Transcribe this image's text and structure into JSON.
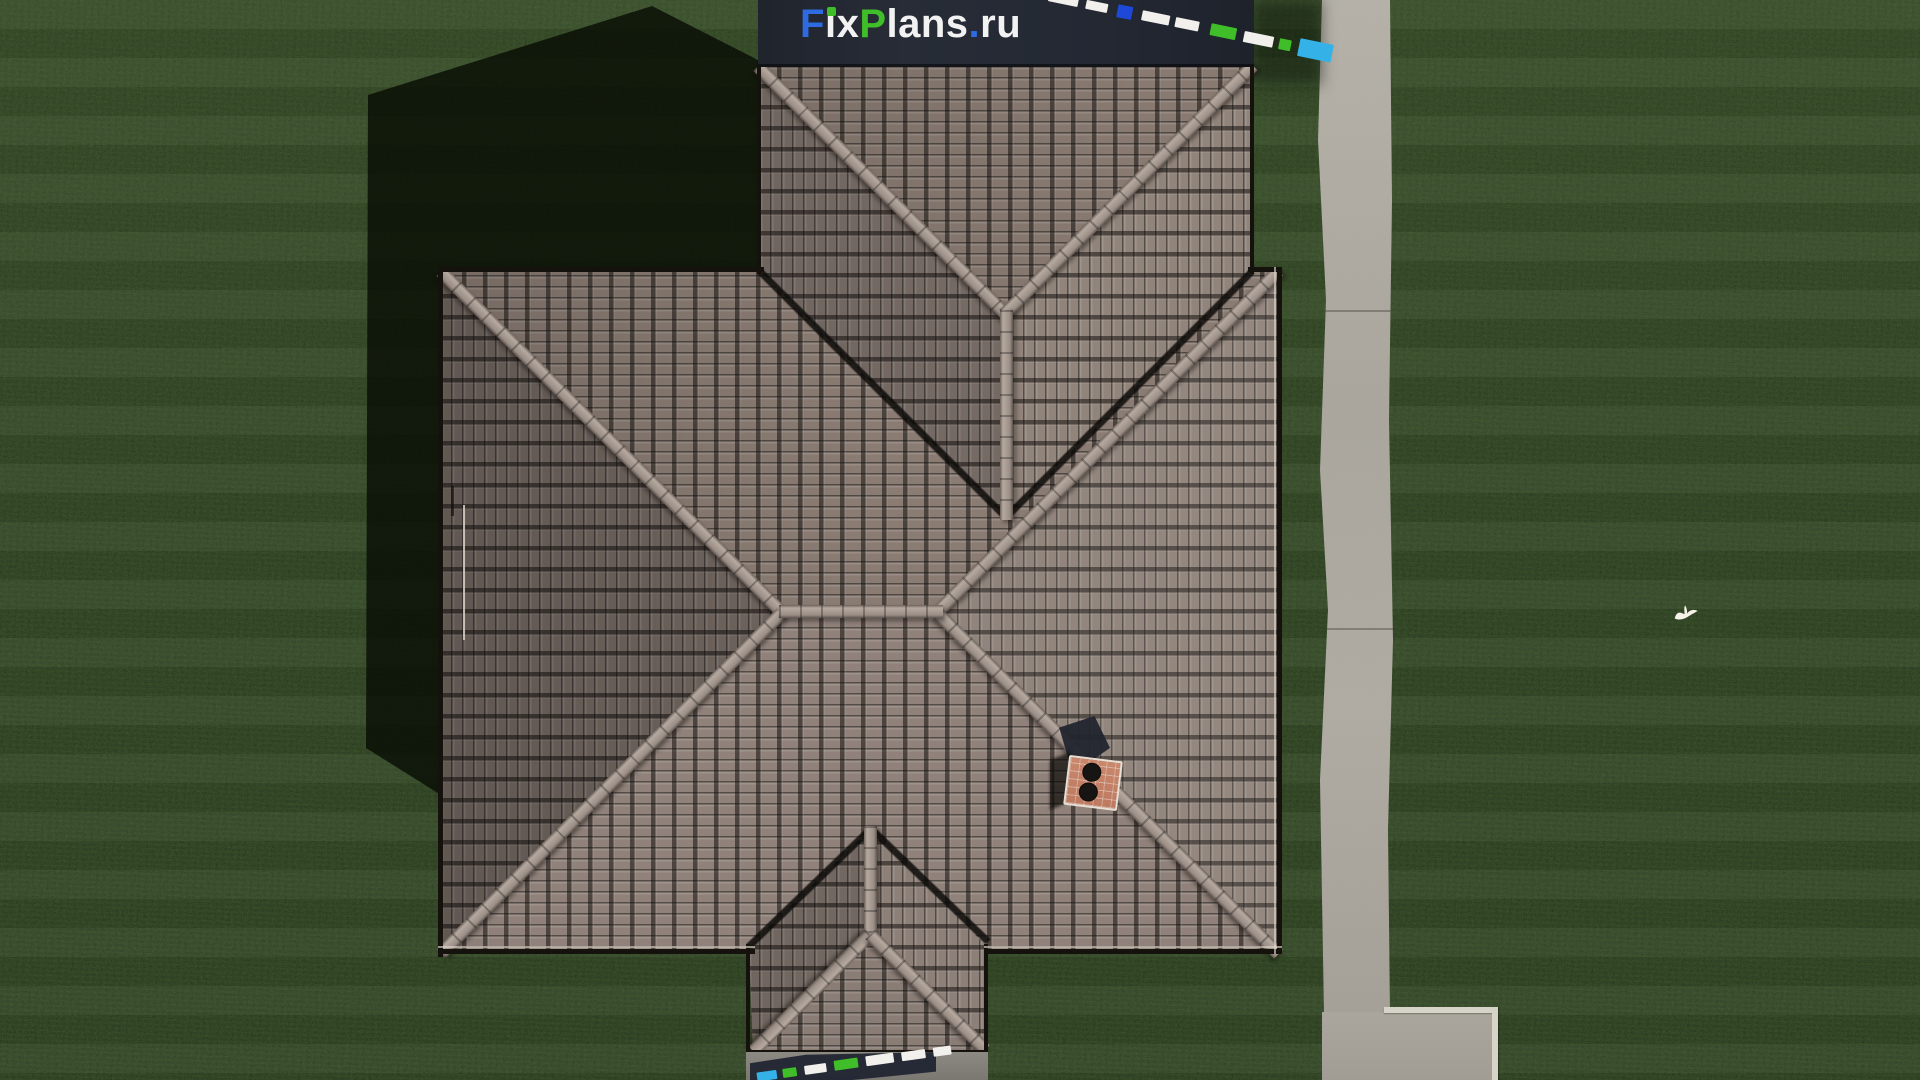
{
  "site_watermark": {
    "text": "FixPlans.ru",
    "parts": [
      {
        "text": "F",
        "color": "#2e6be0"
      },
      {
        "text": "i",
        "color": "#f2f2f2"
      },
      {
        "text": "x",
        "color": "#f2f2f2"
      },
      {
        "text": "P",
        "color": "#3fbe2a"
      },
      {
        "text": "lans",
        "color": "#f2f2f2"
      },
      {
        "text": ".",
        "color": "#2e6be0"
      },
      {
        "text": "ru",
        "color": "#f2f2f2"
      }
    ],
    "i_dot_color": "#3fbe2a"
  },
  "mini_watermarks": {
    "top_right": [
      {
        "c": "#f2f0ec",
        "w": 30,
        "h": 10,
        "g": 8
      },
      {
        "c": "#f2f0ec",
        "w": 22,
        "h": 9,
        "g": 10
      },
      {
        "c": "#1e49d8",
        "w": 15,
        "h": 13,
        "g": 10
      },
      {
        "c": "#f2f0ec",
        "w": 28,
        "h": 10,
        "g": 6
      },
      {
        "c": "#f2f0ec",
        "w": 24,
        "h": 10,
        "g": 12
      },
      {
        "c": "#3fbe2a",
        "w": 26,
        "h": 12,
        "g": 8
      },
      {
        "c": "#f2f0ec",
        "w": 30,
        "h": 11,
        "g": 6
      },
      {
        "c": "#3fbe2a",
        "w": 12,
        "h": 11,
        "g": 8
      },
      {
        "c": "#34b2e8",
        "w": 34,
        "h": 18,
        "g": 0
      }
    ],
    "bottom": [
      {
        "c": "#34b2e8",
        "w": 20,
        "h": 9,
        "g": 6
      },
      {
        "c": "#3fbe2a",
        "w": 14,
        "h": 9,
        "g": 8
      },
      {
        "c": "#f2f0ec",
        "w": 22,
        "h": 9,
        "g": 8
      },
      {
        "c": "#3fbe2a",
        "w": 24,
        "h": 10,
        "g": 8
      },
      {
        "c": "#f2f0ec",
        "w": 28,
        "h": 10,
        "g": 8
      },
      {
        "c": "#f2f0ec",
        "w": 24,
        "h": 9,
        "g": 8
      },
      {
        "c": "#f2f0ec",
        "w": 18,
        "h": 9,
        "g": 0
      }
    ]
  },
  "palette": {
    "brand_blue": "#2e6be0",
    "brand_green": "#3fbe2a",
    "brand_cyan": "#34b2e8",
    "tile_base": "#8d7f77",
    "ridge_cap": "#a69a92",
    "grass_dark": "#24371b",
    "walkway": "#b2aea5",
    "shadow": "#0a0f07",
    "chimney_brick": "#c5826a"
  },
  "scene_objects": {
    "roof": "hip-roof-aerial-view",
    "chimney": "brick-chimney-two-flues",
    "lawn": "striped-mowed-lawn",
    "walkway": "concrete-walkway-with-pad",
    "bird": "white-flying-bird",
    "shadow": "house-cast-shadow"
  }
}
